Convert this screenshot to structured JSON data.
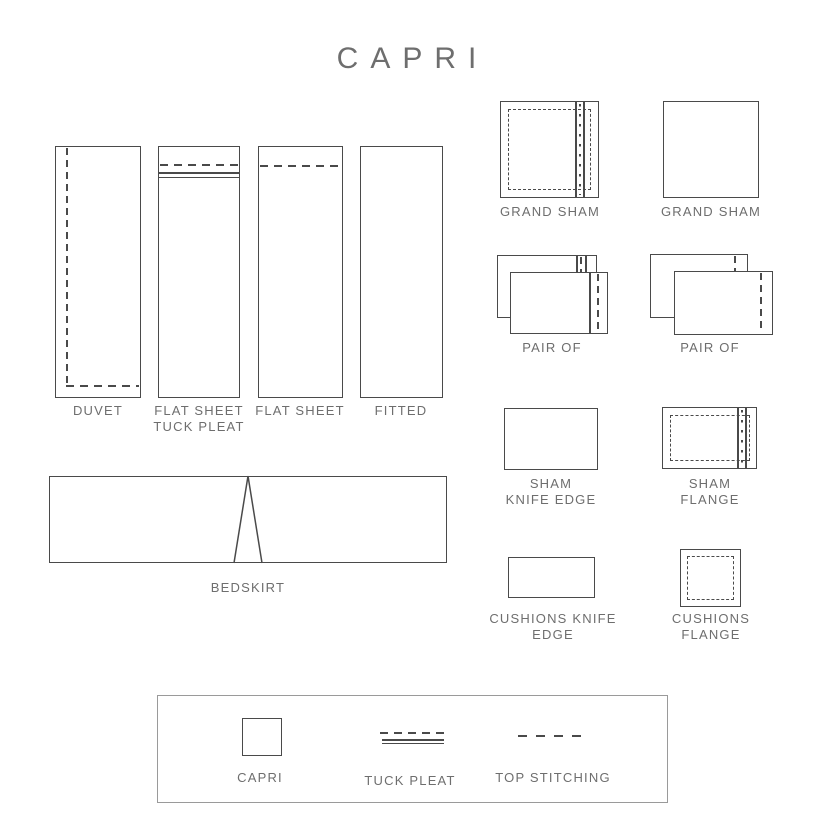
{
  "title": "CAPRI",
  "colors": {
    "line": "#4a4a4a",
    "text": "#6e6e6e",
    "legend_border": "#9a9a9a"
  },
  "labels": {
    "duvet": "DUVET",
    "flat_sheet_tuck_pleat": "FLAT SHEET\nTUCK PLEAT",
    "flat_sheet": "FLAT SHEET",
    "fitted": "FITTED",
    "bedskirt": "BEDSKIRT",
    "grand_sham_flange": "GRAND SHAM",
    "grand_sham_plain": "GRAND SHAM",
    "pair_left": "PAIR OF",
    "pair_right": "PAIR OF",
    "sham_knife_edge": "SHAM\nKNIFE EDGE",
    "sham_flange": "SHAM\nFLANGE",
    "cushions_knife_edge": "CUSHIONS  KNIFE\nEDGE",
    "cushions_flange": "CUSHIONS\nFLANGE"
  },
  "legend": {
    "capri": "CAPRI",
    "tuck_pleat": "TUCK PLEAT",
    "top_stitching": "TOP STITCHING"
  }
}
